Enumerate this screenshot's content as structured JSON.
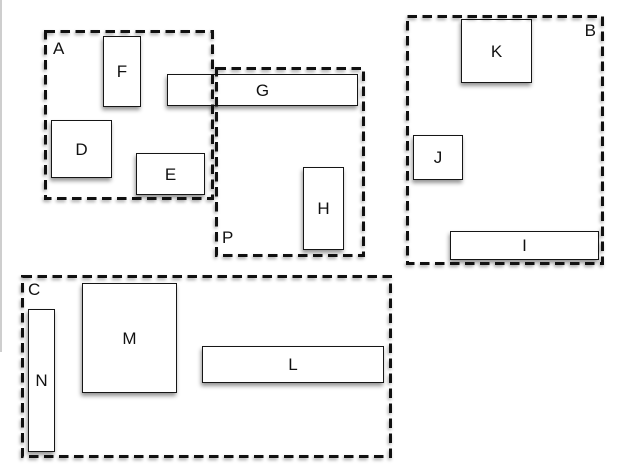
{
  "diagram": {
    "colors": {
      "background": "#ffffff",
      "shape_fill": "#ffffff",
      "stroke": "#111111",
      "shadow": "rgba(0,0,0,0.42)",
      "window_edge": "#bdbdbd"
    },
    "containers": [
      {
        "label": "A",
        "label_position": "top-left",
        "contains": [
          "F",
          "D",
          "E",
          "G"
        ]
      },
      {
        "label": "B",
        "label_position": "top-right",
        "contains": [
          "K",
          "J",
          "I"
        ]
      },
      {
        "label": "C",
        "label_position": "top-left",
        "contains": [
          "N",
          "M",
          "L"
        ]
      },
      {
        "label": "P",
        "label_position": "bottom-left",
        "contains": [
          "G",
          "H"
        ]
      }
    ],
    "boxes": [
      {
        "label": "D",
        "container": "A"
      },
      {
        "label": "E",
        "container": "A"
      },
      {
        "label": "F",
        "container": "A"
      },
      {
        "label": "G",
        "container": "A+P"
      },
      {
        "label": "H",
        "container": "P"
      },
      {
        "label": "I",
        "container": "B"
      },
      {
        "label": "J",
        "container": "B"
      },
      {
        "label": "K",
        "container": "B"
      },
      {
        "label": "L",
        "container": "C"
      },
      {
        "label": "M",
        "container": "C"
      },
      {
        "label": "N",
        "container": "C"
      }
    ]
  }
}
